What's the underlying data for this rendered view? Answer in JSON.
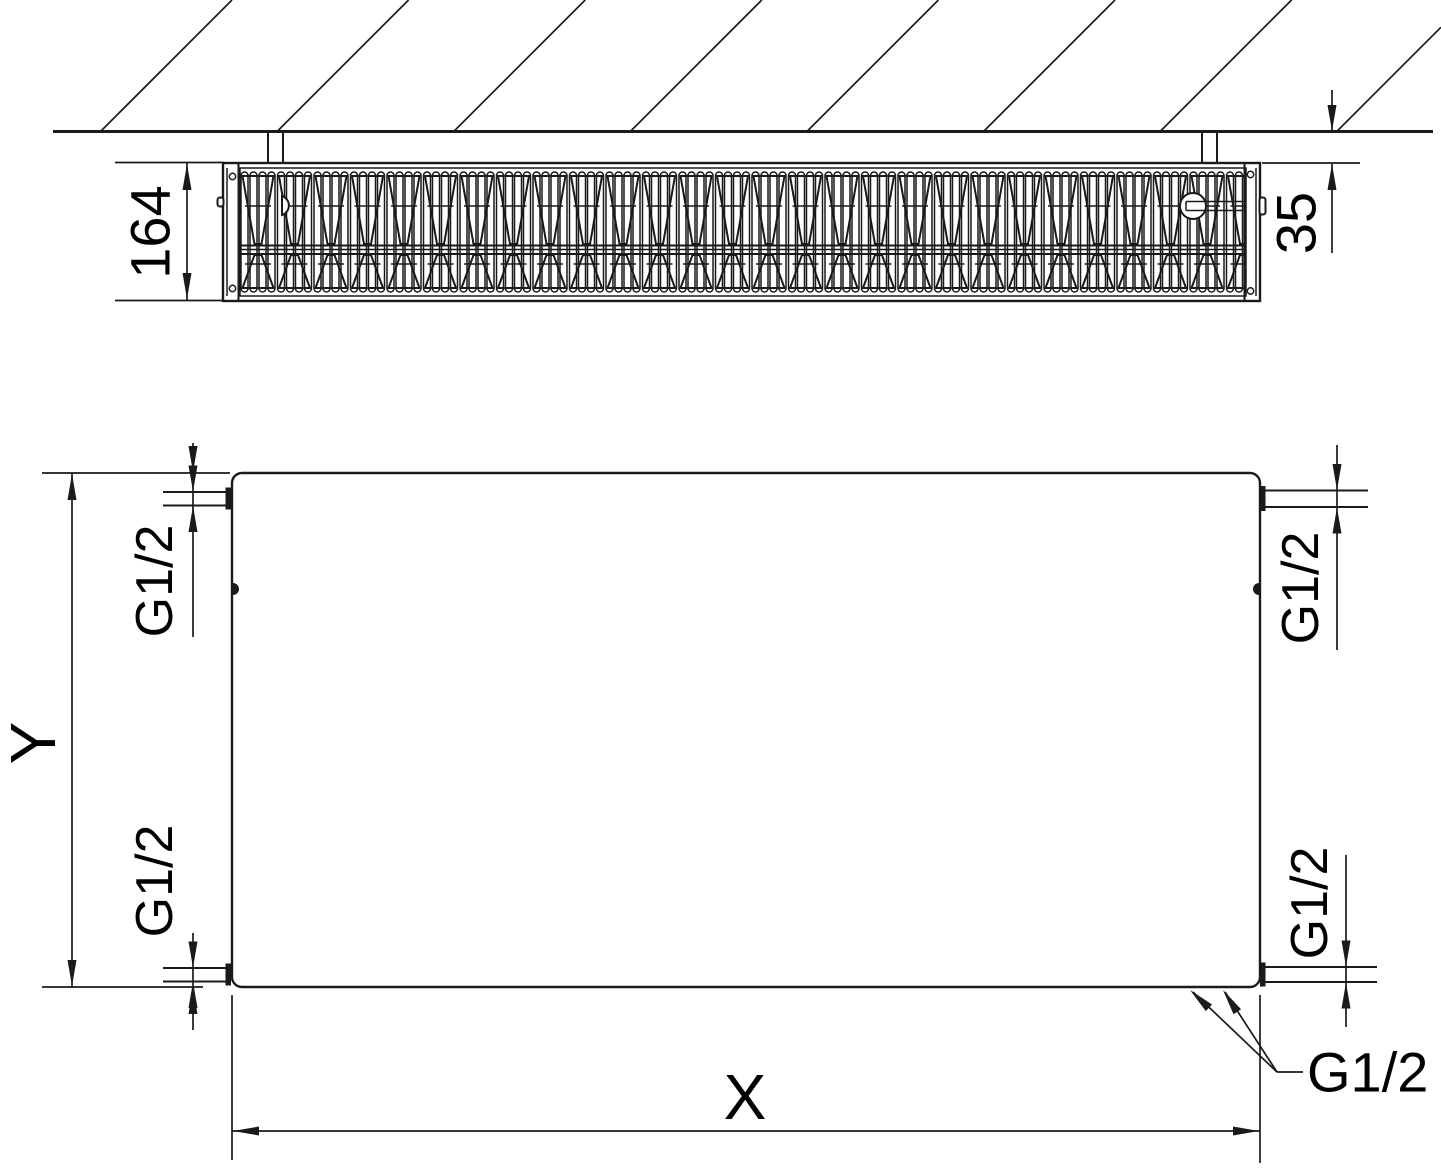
{
  "drawing": {
    "type": "radiator-dimension-diagram",
    "colors": {
      "line": "#1a1a1a",
      "text": "#000000",
      "background": "#ffffff"
    },
    "top_view": {
      "depth_label": "164",
      "wall_distance_label": "35"
    },
    "front_view": {
      "height_label": "Y",
      "width_label": "X"
    },
    "connections": {
      "top_left": "G1/2",
      "bottom_left": "G1/2",
      "top_right": "G1/2",
      "bottom_right": "G1/2",
      "bottom_pair_leader": "G1/2"
    }
  }
}
